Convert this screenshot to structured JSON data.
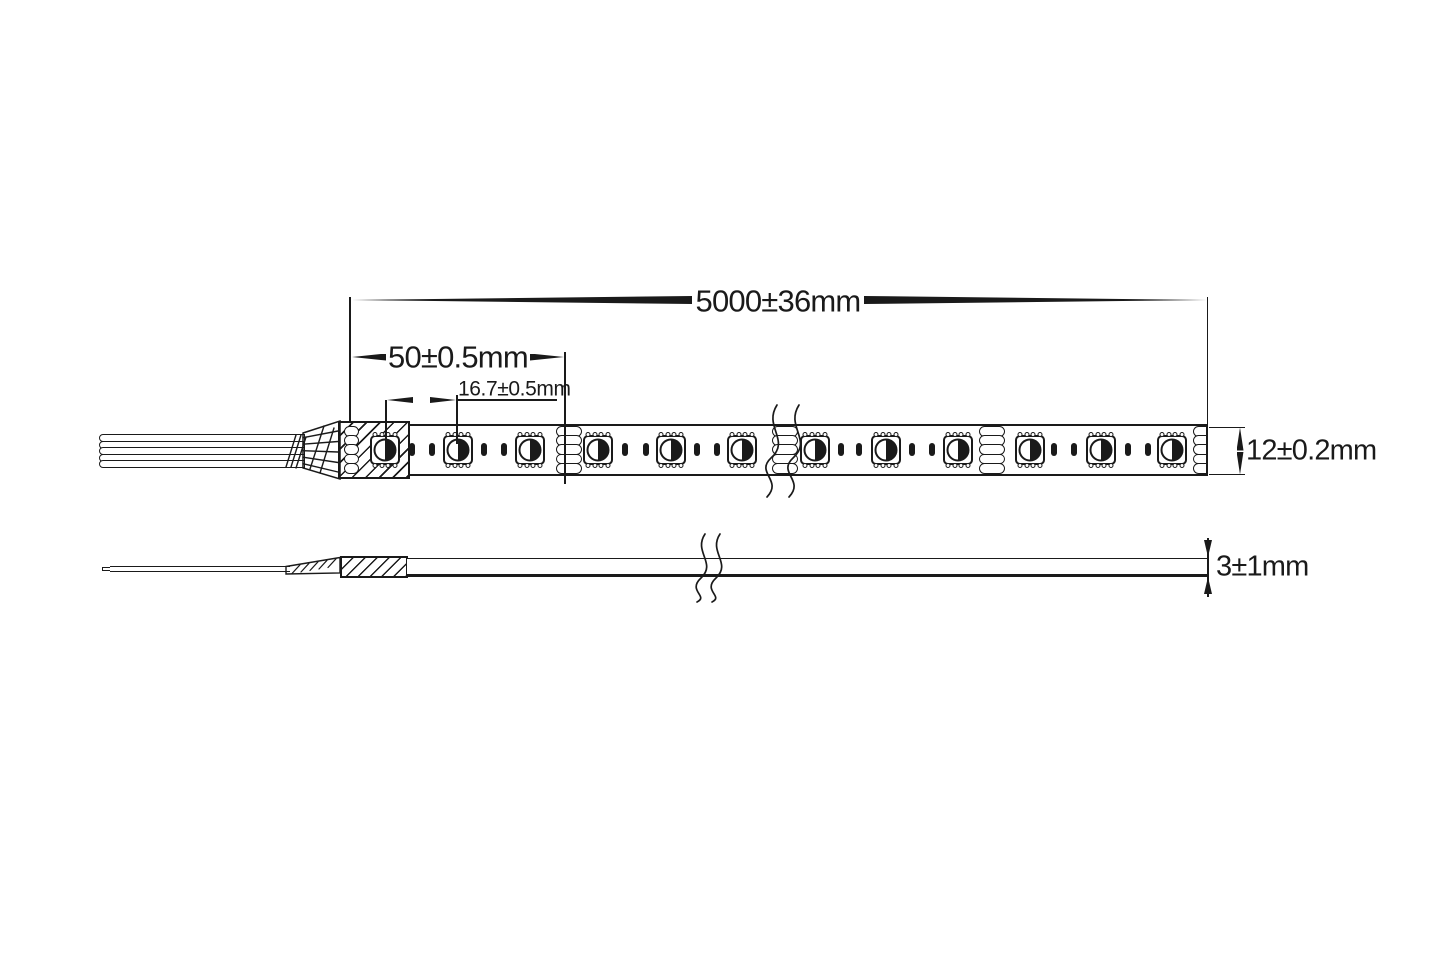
{
  "document": {
    "type": "LED strip technical dimension drawing",
    "views": [
      "top view",
      "side view"
    ]
  },
  "dimensions": {
    "overall_length": "5000±36mm",
    "cuttable_section_length": "50±0.5mm",
    "led_pitch": "16.7±0.5mm",
    "strip_width": "12±0.2mm",
    "strip_thickness": "3±1mm"
  },
  "diagram": {
    "colors": {
      "ink": "#1a1a1a",
      "background": "#ffffff"
    },
    "top_view": {
      "wire_count": 5,
      "led_positions_x": [
        385,
        458,
        530,
        598,
        671,
        742,
        815,
        886,
        958,
        1030,
        1101,
        1172
      ],
      "led_center_y": 450,
      "pad_stack_positions_x": [
        569,
        785,
        992
      ],
      "contact_dot_positions_x": [
        412,
        432,
        484,
        504,
        625,
        646,
        697,
        717,
        841,
        859,
        912,
        932,
        1054,
        1074,
        1128,
        1148
      ],
      "left_pad_column_x": 351,
      "strip_right_edge_x": 1208
    }
  }
}
